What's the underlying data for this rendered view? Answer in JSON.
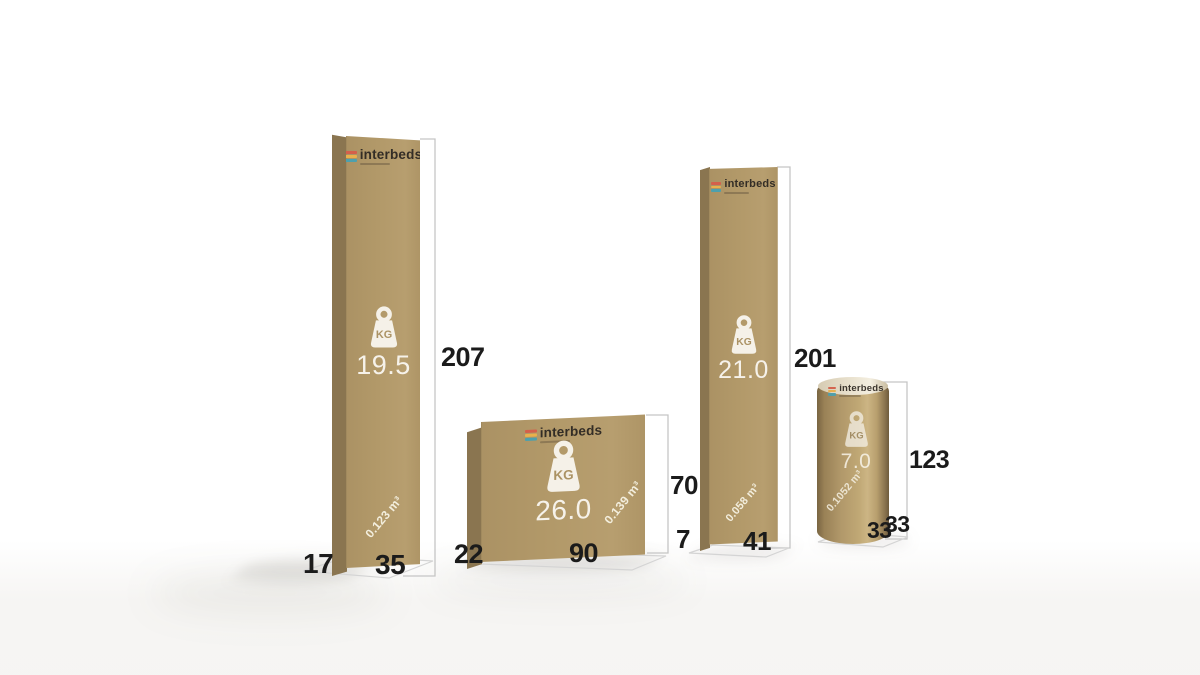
{
  "brand": {
    "name": "interbeds",
    "logo_colors": [
      "#d4604b",
      "#e9b04b",
      "#4da0ad"
    ],
    "text_color": "#332d26"
  },
  "colors": {
    "carton_front": "#b29969",
    "carton_side": "#8a7550",
    "tube_highlight": "#ccb584",
    "print_white": "#f5f1e8",
    "dimension_line": "#c5c5c5",
    "floor_line": "#d4d4d4",
    "label_text": "#1b1b1b",
    "background": "#ffffff"
  },
  "packages": [
    {
      "id": "tall-box-1",
      "shape": "box",
      "kg_label": "KG",
      "weight": "19.5",
      "volume": "0.123 m³",
      "height": "207",
      "width": "35",
      "depth": "17"
    },
    {
      "id": "wide-box-2",
      "shape": "box",
      "kg_label": "KG",
      "weight": "26.0",
      "volume": "0.139 m³",
      "height": "70",
      "width": "90",
      "depth": "22"
    },
    {
      "id": "tall-box-3",
      "shape": "box",
      "kg_label": "KG",
      "weight": "21.0",
      "volume": "0.058 m³",
      "height": "201",
      "width": "41",
      "depth": "7"
    },
    {
      "id": "tube-4",
      "shape": "cylinder",
      "kg_label": "KG",
      "weight": "7.0",
      "volume": "0.1052 m³",
      "height": "123",
      "width": "33",
      "depth": "33"
    }
  ]
}
